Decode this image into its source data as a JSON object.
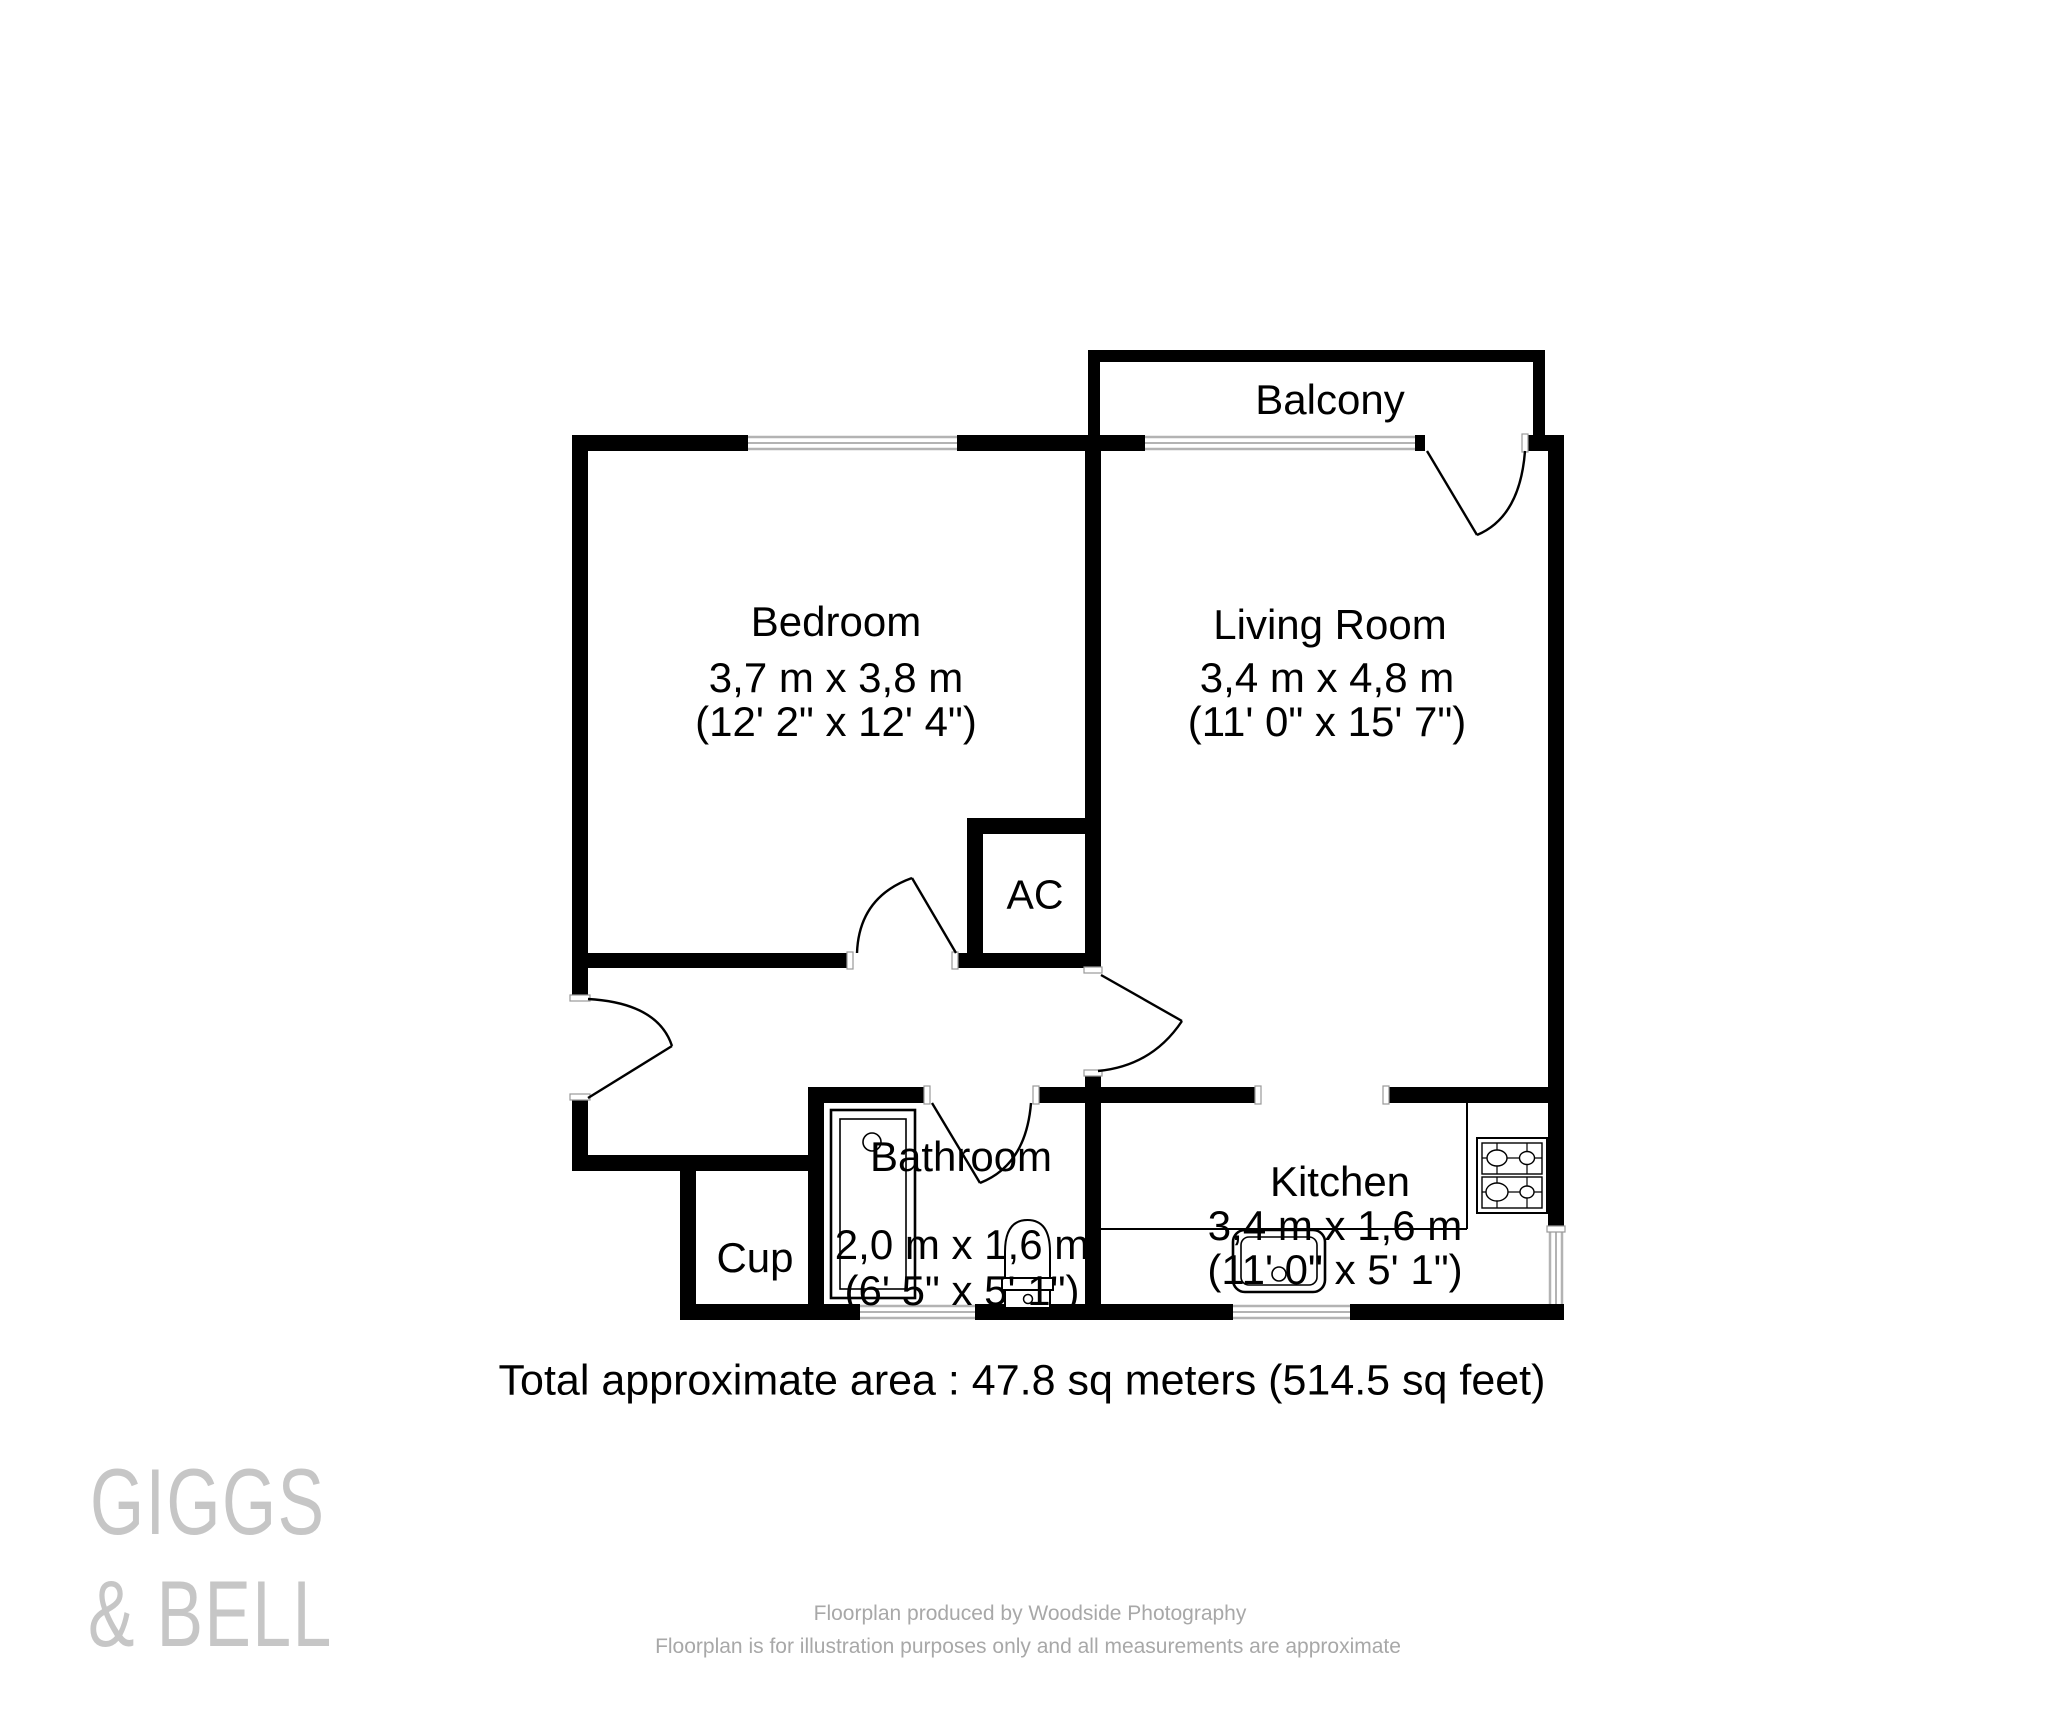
{
  "plan": {
    "rooms": {
      "balcony": {
        "label": "Balcony"
      },
      "bedroom": {
        "label": "Bedroom",
        "metric": "3,7 m x 3,8 m",
        "imperial": "(12' 2\" x 12' 4\")"
      },
      "living": {
        "label": "Living Room",
        "metric": "3,4 m x 4,8 m",
        "imperial": "(11' 0\" x 15' 7\")"
      },
      "ac": {
        "label": "AC"
      },
      "bathroom": {
        "label": "Bathroom",
        "metric": "2,0 m x 1,6 m",
        "imperial": "(6' 5\" x 5' 1\")"
      },
      "cup": {
        "label": "Cup"
      },
      "kitchen": {
        "label": "Kitchen",
        "metric": "3,4 m x 1,6 m",
        "imperial": "(11' 0\" x 5' 1\")"
      }
    },
    "total_area": "Total approximate area : 47.8 sq meters (514.5 sq feet)",
    "fixtures": [
      "bathtub",
      "toilet",
      "sink",
      "stove-4-burner-hob"
    ],
    "doors": [
      "entrance-door",
      "bedroom-door",
      "living-room-door",
      "bathroom-door",
      "balcony-door"
    ],
    "windows": [
      "bedroom-window",
      "balcony-window",
      "bathroom-window",
      "kitchen-window",
      "kitchen-side-window"
    ]
  },
  "branding": {
    "logo_line1": "GIGGS",
    "logo_line2": "& BELL"
  },
  "footer": {
    "line1": "Floorplan produced by Woodside Photography",
    "line2": "Floorplan is for illustration purposes only and all measurements are approximate"
  },
  "colors": {
    "wall": "#000000",
    "window_line": "#b3b3b3",
    "logo_gray": "#c6c6c6",
    "footer_gray": "#a8a8a8"
  }
}
